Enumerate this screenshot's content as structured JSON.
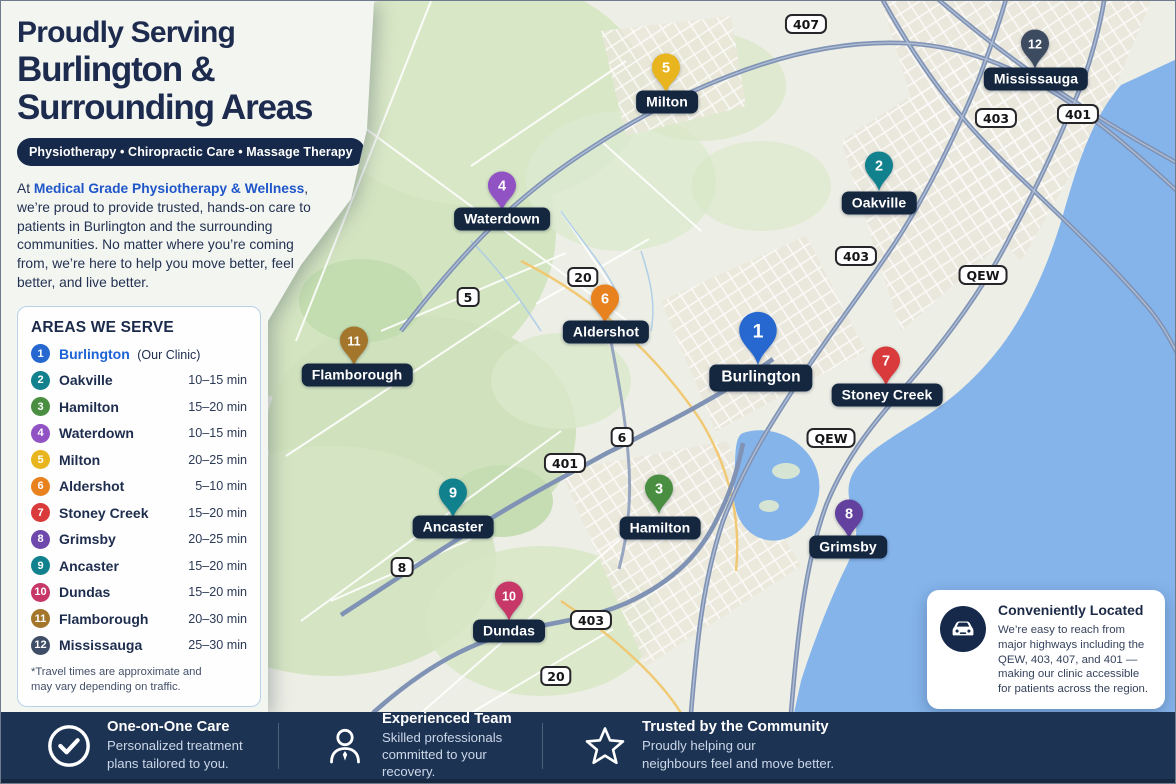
{
  "panel": {
    "title_line1": "Proudly Serving",
    "title_line2": "Burlington &",
    "title_line3": "Surrounding Areas",
    "services_pill": "Physiotherapy  •  Chiropractic Care  •  Massage Therapy",
    "intro": {
      "prefix": "At ",
      "brand": "Medical Grade Physiotherapy & Wellness",
      "suffix": ", we’re proud to provide trusted, hands-on care to patients in Burlington and the surrounding communities. No matter where you’re coming from, we’re here to help you move better, feel better, and live better."
    },
    "areas_card": {
      "title": "AREAS WE SERVE",
      "footnote": "*Travel times are approximate and may vary depending on traffic.",
      "items": [
        {
          "num": 1,
          "name": "Burlington",
          "note": "(Our Clinic)",
          "time": "",
          "color": "#2668d0",
          "highlight": true
        },
        {
          "num": 2,
          "name": "Oakville",
          "time": "10–15 min",
          "color": "#12818e"
        },
        {
          "num": 3,
          "name": "Hamilton",
          "time": "15–20 min",
          "color": "#4a8f41"
        },
        {
          "num": 4,
          "name": "Waterdown",
          "time": "10–15 min",
          "color": "#9152c4"
        },
        {
          "num": 5,
          "name": "Milton",
          "time": "20–25 min",
          "color": "#e9b51e"
        },
        {
          "num": 6,
          "name": "Aldershot",
          "time": "5–10 min",
          "color": "#e8821f"
        },
        {
          "num": 7,
          "name": "Stoney Creek",
          "time": "15–20 min",
          "color": "#d93a3c"
        },
        {
          "num": 8,
          "name": "Grimsby",
          "time": "20–25 min",
          "color": "#6e48ac"
        },
        {
          "num": 9,
          "name": "Ancaster",
          "time": "15–20 min",
          "color": "#12818e"
        },
        {
          "num": 10,
          "name": "Dundas",
          "time": "15–20 min",
          "color": "#c73768"
        },
        {
          "num": 11,
          "name": "Flamborough",
          "time": "20–30 min",
          "color": "#a3762b"
        },
        {
          "num": 12,
          "name": "Mississauga",
          "time": "25–30 min",
          "color": "#3f4e66"
        }
      ]
    }
  },
  "map": {
    "markers": [
      {
        "num": 1,
        "label": "Burlington",
        "color": "#2668d0",
        "x": 757,
        "y": 329,
        "label_x": 760,
        "label_y": 377,
        "large": true
      },
      {
        "num": 2,
        "label": "Oakville",
        "color": "#12818e",
        "x": 878,
        "y": 164,
        "label_x": 878,
        "label_y": 202
      },
      {
        "num": 3,
        "label": "Hamilton",
        "color": "#4a8f41",
        "x": 658,
        "y": 487,
        "label_x": 659,
        "label_y": 527
      },
      {
        "num": 4,
        "label": "Waterdown",
        "color": "#9152c4",
        "x": 501,
        "y": 184,
        "label_x": 501,
        "label_y": 218
      },
      {
        "num": 5,
        "label": "Milton",
        "color": "#e9b51e",
        "x": 665,
        "y": 66,
        "label_x": 666,
        "label_y": 101
      },
      {
        "num": 6,
        "label": "Aldershot",
        "color": "#e8821f",
        "x": 604,
        "y": 297,
        "label_x": 605,
        "label_y": 331
      },
      {
        "num": 7,
        "label": "Stoney Creek",
        "color": "#d93a3c",
        "x": 885,
        "y": 359,
        "label_x": 886,
        "label_y": 394
      },
      {
        "num": 8,
        "label": "Grimsby",
        "color": "#63419f",
        "x": 848,
        "y": 512,
        "label_x": 847,
        "label_y": 546
      },
      {
        "num": 9,
        "label": "Ancaster",
        "color": "#12818e",
        "x": 452,
        "y": 491,
        "label_x": 452,
        "label_y": 526
      },
      {
        "num": 10,
        "label": "Dundas",
        "color": "#c73768",
        "x": 508,
        "y": 594,
        "label_x": 508,
        "label_y": 630
      },
      {
        "num": 11,
        "label": "Flamborough",
        "color": "#a3762b",
        "x": 353,
        "y": 339,
        "label_x": 356,
        "label_y": 374
      },
      {
        "num": 12,
        "label": "Mississauga",
        "color": "#3d4b61",
        "x": 1034,
        "y": 42,
        "label_x": 1035,
        "label_y": 78
      }
    ],
    "road_badges": [
      {
        "text": "407",
        "x": 805,
        "y": 23,
        "type": "rect"
      },
      {
        "text": "403",
        "x": 995,
        "y": 117,
        "type": "rect"
      },
      {
        "text": "401",
        "x": 1077,
        "y": 113,
        "type": "rect"
      },
      {
        "text": "403",
        "x": 855,
        "y": 255,
        "type": "rect"
      },
      {
        "text": "QEW",
        "x": 982,
        "y": 274,
        "type": "rect"
      },
      {
        "text": "20",
        "x": 582,
        "y": 276,
        "type": "shield"
      },
      {
        "text": "5",
        "x": 467,
        "y": 296,
        "type": "shield"
      },
      {
        "text": "6",
        "x": 621,
        "y": 436,
        "type": "shield"
      },
      {
        "text": "QEW",
        "x": 830,
        "y": 437,
        "type": "rect"
      },
      {
        "text": "401",
        "x": 564,
        "y": 462,
        "type": "rect"
      },
      {
        "text": "8",
        "x": 401,
        "y": 566,
        "type": "shield"
      },
      {
        "text": "403",
        "x": 590,
        "y": 619,
        "type": "rect"
      },
      {
        "text": "20",
        "x": 555,
        "y": 675,
        "type": "shield"
      }
    ]
  },
  "location_card": {
    "title": "Conveniently Located",
    "body": "We’re easy to reach from major highways including the QEW, 403, 407, and 401 — making our clinic accessible for patients across the region."
  },
  "footer": {
    "features": [
      {
        "icon": "check-circle",
        "title": "One-on-One Care",
        "line1": "Personalized treatment",
        "line2": "plans tailored to you."
      },
      {
        "icon": "person",
        "title": "Experienced Team",
        "line1": "Skilled professionals",
        "line2": "committed to your recovery."
      },
      {
        "icon": "star",
        "title": "Trusted by the Community",
        "line1": "Proudly helping our",
        "line2": "neighbours feel and move better."
      }
    ]
  },
  "colors": {
    "navy": "#16294a",
    "label_pill": "#14273f",
    "footer_bg": "#1c3354",
    "brand_blue": "#1f56c9",
    "water": "#85b4eb",
    "map_base": "#edeee5"
  }
}
